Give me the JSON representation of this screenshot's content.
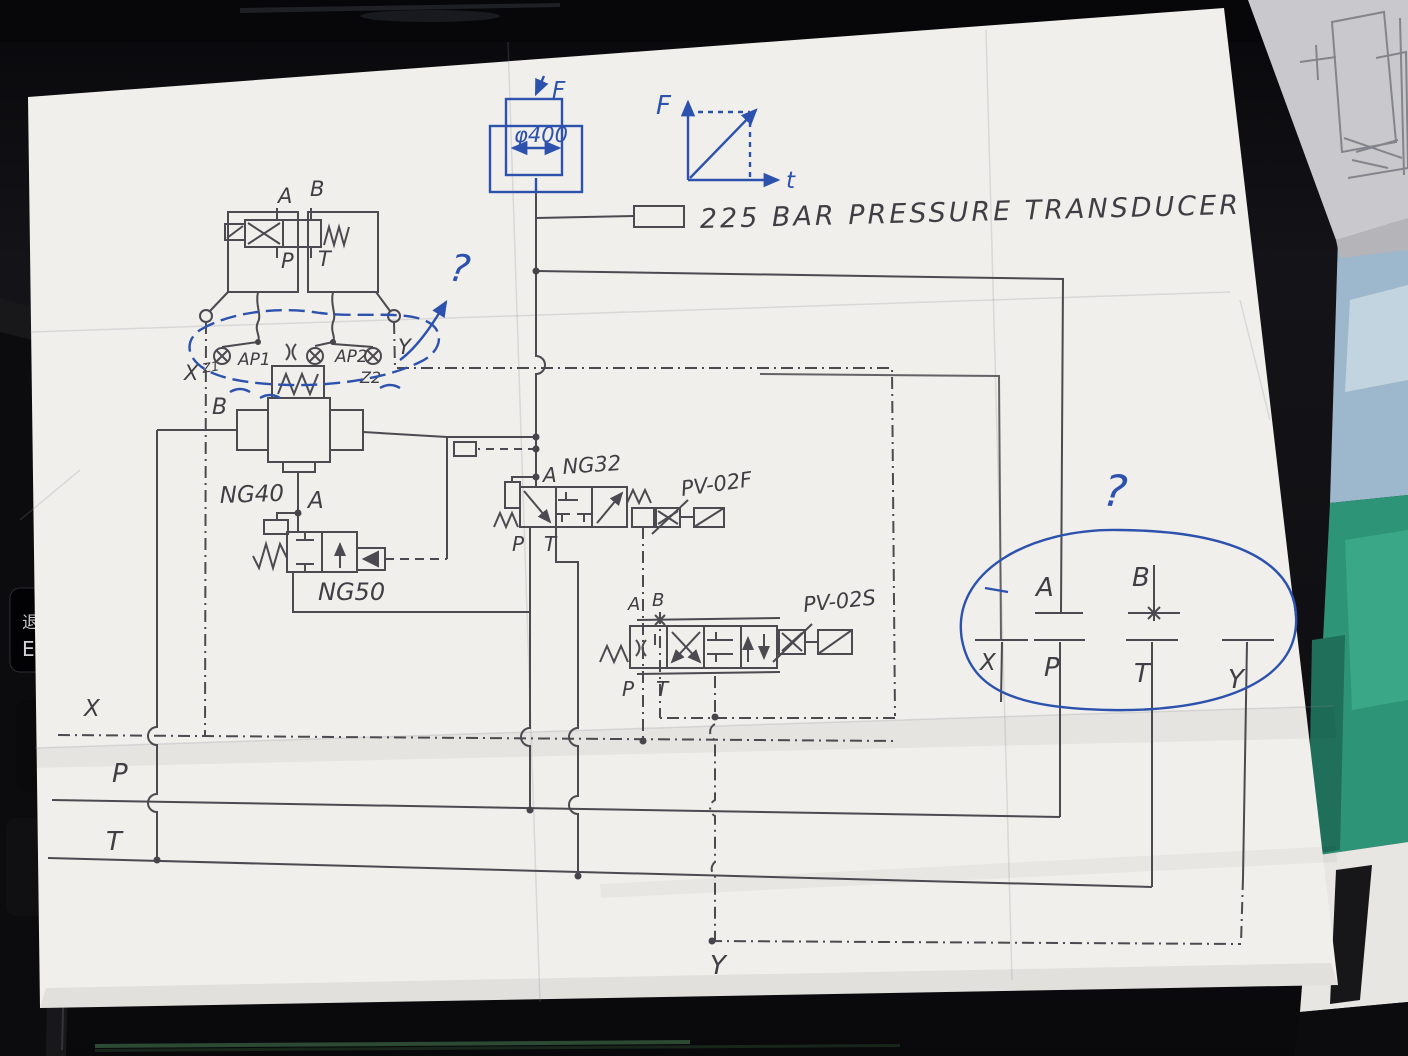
{
  "scene": {
    "desk_color": "#101014",
    "paper_color": "#f0efeb",
    "ink_blue": "#2d52ae",
    "pencil": "#4a4a50"
  },
  "keyboard": {
    "key_cn": "退",
    "key_en": "Es"
  },
  "diagram": {
    "cylinder": {
      "bore_label": "φ400",
      "force_label": "F"
    },
    "graph": {
      "y_label": "F",
      "x_label": "t"
    },
    "transducer": {
      "label": "225 BAR PRESSURE TRANSDUCER"
    },
    "top_valve": {
      "a": "A",
      "b": "B",
      "p": "P",
      "t": "T"
    },
    "manifold": {
      "x": "X",
      "z1": "Z1",
      "ap1": "AP1",
      "ap2": "AP2",
      "z2": "Z2",
      "y": "Y",
      "b": "B"
    },
    "ng40": {
      "label": "NG40",
      "port_a": "A"
    },
    "ng50": {
      "label": "NG50"
    },
    "ng32": {
      "label": "NG32",
      "port_a": "A",
      "port_p": "P",
      "port_t": "T"
    },
    "pv02f": {
      "label": "PV-02F"
    },
    "pv02s": {
      "label": "PV-02S",
      "port_a": "A",
      "port_b": "B",
      "port_p": "P",
      "port_t": "T"
    },
    "rails": {
      "x": "X",
      "p": "P",
      "t": "T",
      "y": "Y"
    },
    "interface": {
      "a": "A",
      "b": "B",
      "x": "X",
      "p": "P",
      "t": "T",
      "y": "Y"
    },
    "annotations": {
      "q_left": "?",
      "q_right": "?"
    }
  }
}
